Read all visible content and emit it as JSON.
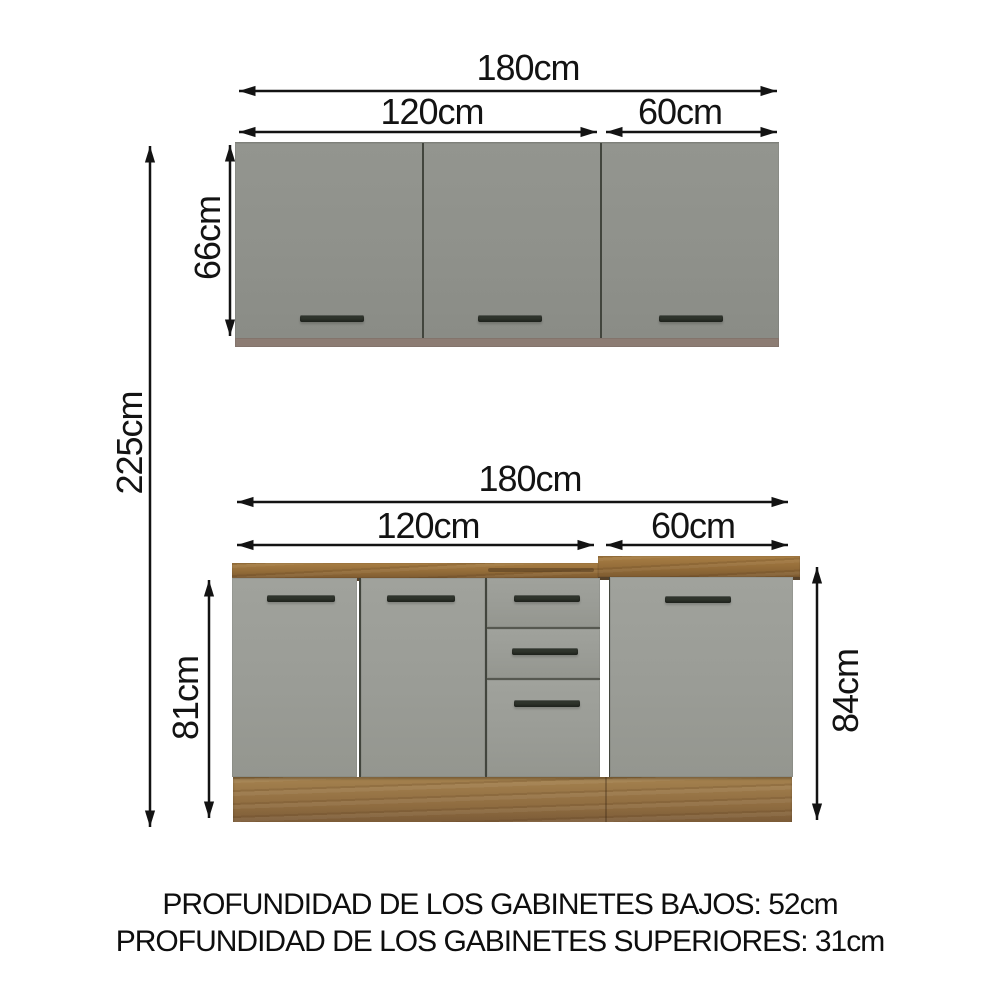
{
  "dimensions": {
    "upper": {
      "total_width": "180cm",
      "left_width": "120cm",
      "right_width": "60cm",
      "height": "66cm"
    },
    "lower": {
      "total_width": "180cm",
      "left_width": "120cm",
      "right_width": "60cm",
      "left_height": "81cm",
      "right_height": "84cm"
    },
    "overall_height": "225cm"
  },
  "footer": {
    "line1": "PROFUNDIDAD DE LOS GABINETES BAJOS: 52cm",
    "line2": "PROFUNDIDAD DE LOS GABINETES SUPERIORES: 31cm"
  },
  "colors": {
    "background": "#FFFFFF",
    "door_gray": "#90928C",
    "wood": "#9A7440",
    "wood_dark": "#57422A",
    "handle": "#2F342C",
    "dimension_line": "#131313"
  }
}
